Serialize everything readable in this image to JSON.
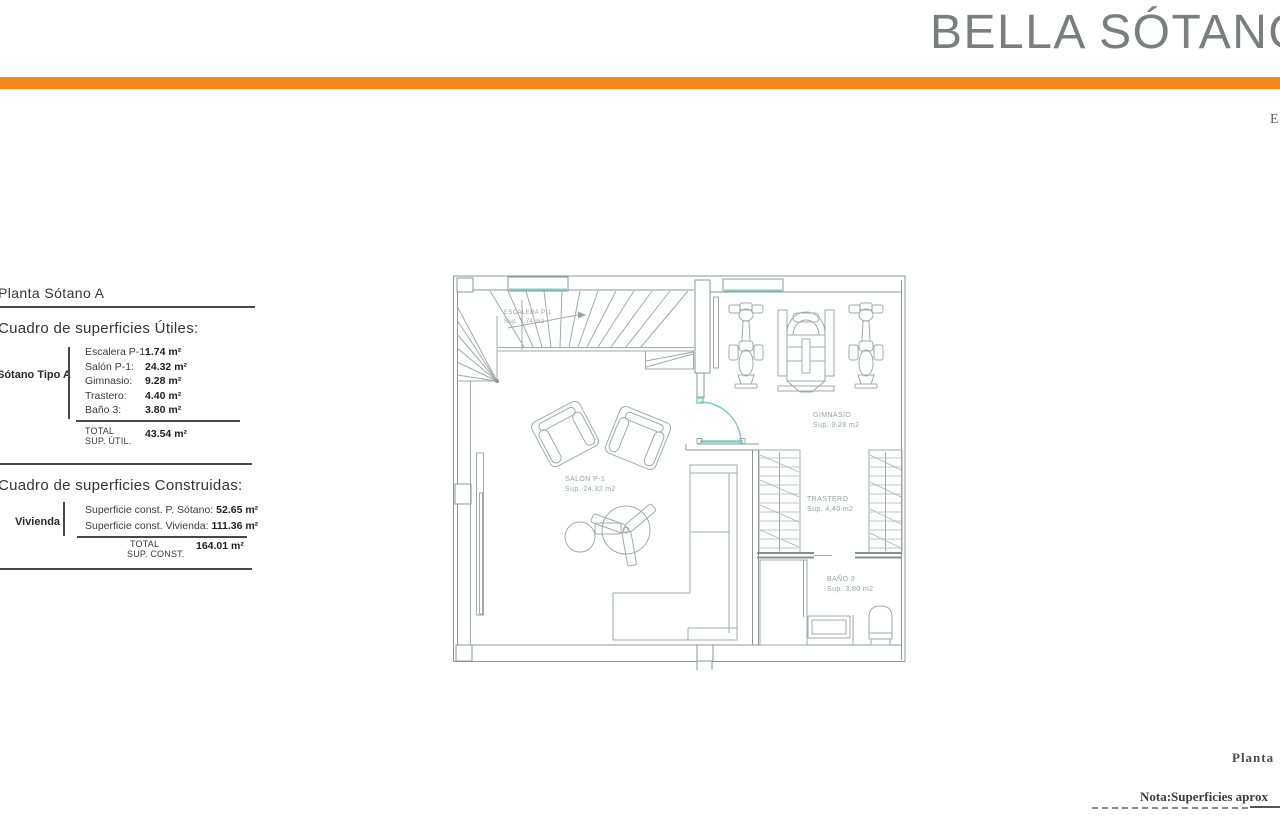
{
  "header": {
    "title": "BELLA SÓTANO",
    "edge_letter": "E"
  },
  "colors": {
    "accent_orange": "#F5881B",
    "teal": "#82CBC7",
    "plan_line": "#9aa0a3",
    "title_gray": "#7b7d80"
  },
  "surfaces_panel": {
    "heading": "Planta Sótano A",
    "utiles": {
      "title": "Cuadro de superficies Útiles:",
      "group_label": "Sótano Tipo A",
      "rows": [
        {
          "label": "Escalera P-1:",
          "value": "1.74 m²"
        },
        {
          "label": "Salón P-1:",
          "value": "24.32 m²"
        },
        {
          "label": "Gimnasio:",
          "value": "9.28 m²"
        },
        {
          "label": "Trastero:",
          "value": "4.40 m²"
        },
        {
          "label": "Baño 3:",
          "value": "3.80 m²"
        }
      ],
      "total_label_1": "TOTAL",
      "total_label_2": "SUP. ÚTIL.",
      "total_value": "43.54 m²"
    },
    "construidas": {
      "title": "Cuadro de superficies Construidas:",
      "group_label": "Vivienda",
      "rows": [
        {
          "label": "Superficie const. P. Sótano:",
          "value": "52.65 m²"
        },
        {
          "label": "Superficie const. Vivienda:",
          "value": "111.36 m²"
        }
      ],
      "total_label_1": "TOTAL",
      "total_label_2": "SUP. CONST.",
      "total_value": "164.01 m²"
    }
  },
  "floor_plan": {
    "rooms": [
      {
        "name": "ESCALERA P-1",
        "area": "Sup. 1,74 m2"
      },
      {
        "name": "SALÓN P-1",
        "area": "Sup. 24,32 m2"
      },
      {
        "name": "GIMNASIO",
        "area": "Sup. 9,28 m2"
      },
      {
        "name": "TRASTERO",
        "area": "Sup. 4,40 m2"
      },
      {
        "name": "BAÑO 3",
        "area": "Sup. 3,80 m2"
      }
    ]
  },
  "footer": {
    "caption": "Planta",
    "note": "Nota:Superficies aprox"
  }
}
